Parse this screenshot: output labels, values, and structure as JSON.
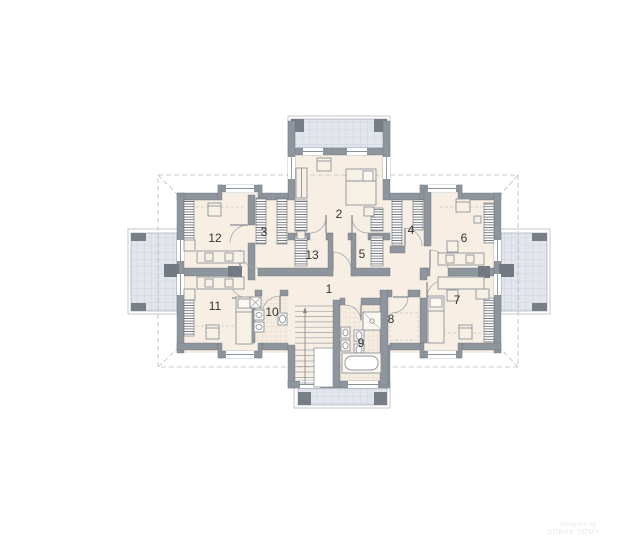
{
  "plan": {
    "rooms": [
      {
        "label": "1"
      },
      {
        "label": "2"
      },
      {
        "label": "3"
      },
      {
        "label": "4"
      },
      {
        "label": "5"
      },
      {
        "label": "6"
      },
      {
        "label": "7"
      },
      {
        "label": "8"
      },
      {
        "label": "9"
      },
      {
        "label": "10"
      },
      {
        "label": "11"
      },
      {
        "label": "12"
      },
      {
        "label": "13"
      }
    ],
    "watermark": {
      "line1": "Designed by",
      "line2": "DOBRE DOMY"
    },
    "colors": {
      "wall": "#8e959d",
      "wall_dark": "#7a8089",
      "floor": "#f8efe4",
      "tile_floor": "#f5ede1",
      "balcony": "#e2e6ec",
      "balcony_grid": "#c7cdd7",
      "hatch_line": "#474c52",
      "dashed_line": "#bdbdbd",
      "furniture_stroke": "#8d939b",
      "furniture_fill": "#f7f0e5",
      "label_color": "#333333"
    }
  }
}
